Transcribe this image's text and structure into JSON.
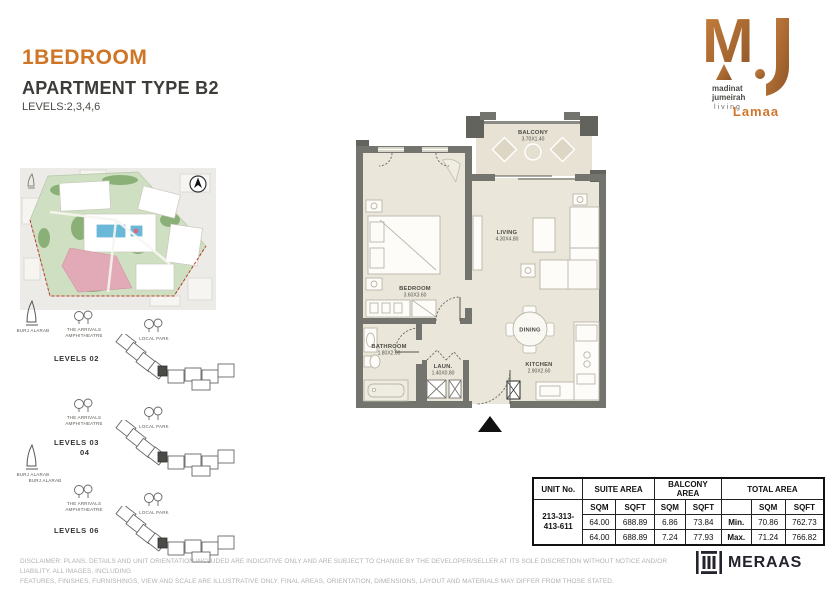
{
  "header": {
    "title": "1BEDROOM",
    "subtitle": "APARTMENT TYPE B2",
    "levels": "LEVELS:2,3,4,6"
  },
  "brand": {
    "lines": [
      "madinat",
      "jumeirah",
      "living"
    ],
    "project": "Lamaa"
  },
  "site_plan": {
    "diagrams": [
      {
        "line1": "LEVELS  02",
        "line2": "",
        "burj": "BURJ ALARAB",
        "amph1": "THE ARRIVALS",
        "amph2": "AMPHITHEATRE",
        "park": "LOCAL PARK"
      },
      {
        "line1": "LEVELS 03",
        "line2": "04",
        "burj": "BURJ ALARAB",
        "amph1": "THE ARRIVALS",
        "amph2": "AMPHITHEATRE",
        "park": "LOCAL PARK"
      },
      {
        "line1": "LEVELS  06",
        "line2": "",
        "burj": "BURJ ALARAB",
        "amph1": "THE ARRIVALS",
        "amph2": "AMPHITHEATRE",
        "park": "LOCAL PARK"
      }
    ]
  },
  "floor_plan": {
    "rooms": [
      {
        "name": "BALCONY",
        "dims": "3.70X1.40"
      },
      {
        "name": "LIVING",
        "dims": "4.30X4.80"
      },
      {
        "name": "BEDROOM",
        "dims": "3.60X3.60"
      },
      {
        "name": "BATHROOM",
        "dims": "1.80X2.60"
      },
      {
        "name": "LAUN.",
        "dims": "1.40X0.80"
      },
      {
        "name": "DINING",
        "dims": ""
      },
      {
        "name": "KITCHEN",
        "dims": "2.90X2.60"
      }
    ]
  },
  "area_table": {
    "headers": {
      "unit": "UNIT No.",
      "suite": "SUITE AREA",
      "balcony": "BALCONY AREA",
      "total": "TOTAL AREA",
      "sqm": "SQM",
      "sqft": "SQFT"
    },
    "unit_no_lines": [
      "213-313-",
      "413-611"
    ],
    "rows": [
      {
        "suite_sqm": "64.00",
        "suite_sqft": "688.89",
        "balcony_sqm": "6.86",
        "balcony_sqft": "73.84",
        "minmax": "Min.",
        "total_sqm": "70.86",
        "total_sqft": "762.73"
      },
      {
        "suite_sqm": "64.00",
        "suite_sqft": "688.89",
        "balcony_sqm": "7.24",
        "balcony_sqft": "77.93",
        "minmax": "Max.",
        "total_sqm": "71.24",
        "total_sqft": "766.82"
      }
    ]
  },
  "footer": {
    "disclaimer1": "DISCLAIMER: PLANS, DETAILS AND UNIT ORIENTATION INCLUDED ARE INDICATIVE ONLY AND ARE SUBJECT TO CHANGE BY THE DEVELOPER/SELLER AT ITS SOLE DISCRETION WITHOUT NOTICE AND/OR LIABILITY. ALL IMAGES, INCLUDING",
    "disclaimer2": "FEATURES, FINISHES, FURNISHINGS, VIEW AND SCALE ARE ILLUSTRATIVE ONLY. FINAL AREAS, ORIENTATION, DIMENSIONS, LAYOUT AND MATERIALS MAY DIFFER FROM THOSE STATED.",
    "brand": "MERAAS"
  },
  "colors": {
    "accent_orange": "#CE7526",
    "logo_copper": "#B06C3A",
    "wall_gray": "#74746E",
    "floor_beige": "#EAE6D9",
    "balcony_beige": "#E7E2D4",
    "map_green": "#CFE0C2",
    "map_pink": "#E2AAB6",
    "pool_blue": "#69B8D8",
    "boundary_red": "#C0392B"
  }
}
